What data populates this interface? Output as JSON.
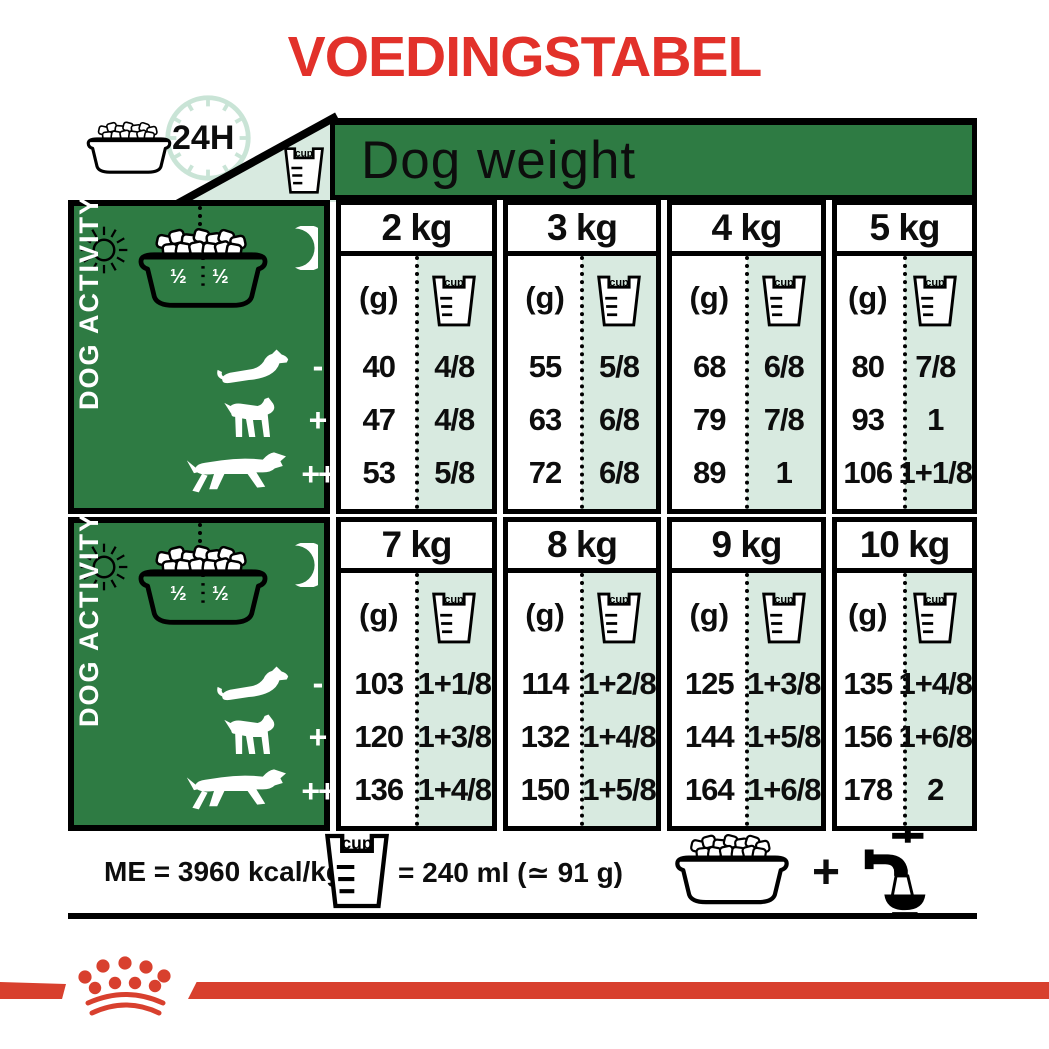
{
  "title": "VOEDINGSTABEL",
  "header": {
    "dog_weight_label": "Dog weight",
    "hours_label": "24H",
    "cup_label": "cup"
  },
  "activity_panel": {
    "label": "DOG ACTIVITY",
    "half_left": "½",
    "half_right": "½",
    "levels": [
      "-",
      "+",
      "++"
    ]
  },
  "table": {
    "grams_header": "(g)",
    "sections": [
      {
        "columns": [
          {
            "weight": "2 kg",
            "rows": [
              {
                "g": "40",
                "cup": "4/8"
              },
              {
                "g": "47",
                "cup": "4/8"
              },
              {
                "g": "53",
                "cup": "5/8"
              }
            ]
          },
          {
            "weight": "3 kg",
            "rows": [
              {
                "g": "55",
                "cup": "5/8"
              },
              {
                "g": "63",
                "cup": "6/8"
              },
              {
                "g": "72",
                "cup": "6/8"
              }
            ]
          },
          {
            "weight": "4 kg",
            "rows": [
              {
                "g": "68",
                "cup": "6/8"
              },
              {
                "g": "79",
                "cup": "7/8"
              },
              {
                "g": "89",
                "cup": "1"
              }
            ]
          },
          {
            "weight": "5 kg",
            "rows": [
              {
                "g": "80",
                "cup": "7/8"
              },
              {
                "g": "93",
                "cup": "1"
              },
              {
                "g": "106",
                "cup": "1+1/8"
              }
            ]
          }
        ]
      },
      {
        "columns": [
          {
            "weight": "7 kg",
            "rows": [
              {
                "g": "103",
                "cup": "1+1/8"
              },
              {
                "g": "120",
                "cup": "1+3/8"
              },
              {
                "g": "136",
                "cup": "1+4/8"
              }
            ]
          },
          {
            "weight": "8 kg",
            "rows": [
              {
                "g": "114",
                "cup": "1+2/8"
              },
              {
                "g": "132",
                "cup": "1+4/8"
              },
              {
                "g": "150",
                "cup": "1+5/8"
              }
            ]
          },
          {
            "weight": "9 kg",
            "rows": [
              {
                "g": "125",
                "cup": "1+3/8"
              },
              {
                "g": "144",
                "cup": "1+5/8"
              },
              {
                "g": "164",
                "cup": "1+6/8"
              }
            ]
          },
          {
            "weight": "10 kg",
            "rows": [
              {
                "g": "135",
                "cup": "1+4/8"
              },
              {
                "g": "156",
                "cup": "1+6/8"
              },
              {
                "g": "178",
                "cup": "2"
              }
            ]
          }
        ]
      }
    ]
  },
  "footer": {
    "energy_label": "ME = 3960 kcal/kg",
    "cup_equiv_label": "= 240 ml (≃ 91 g)",
    "plus_label": "+"
  },
  "colors": {
    "brand_red": "#e2312a",
    "stripe_red": "#d8402e",
    "dark_green": "#2e7b43",
    "mint": "#d8eae0",
    "clock_mint": "#c9e4d6"
  }
}
